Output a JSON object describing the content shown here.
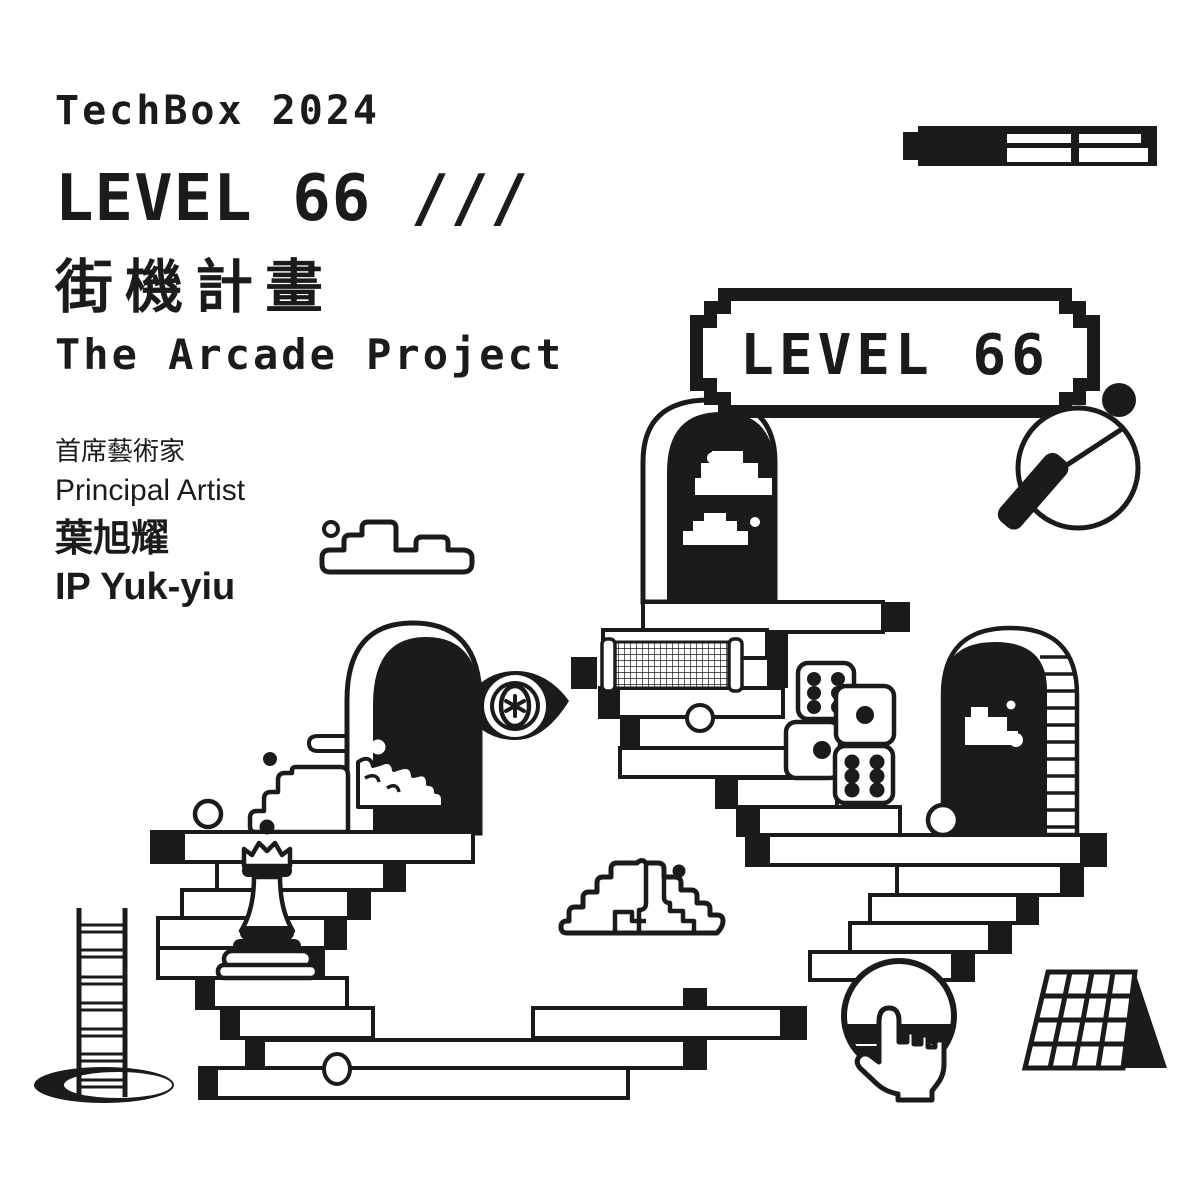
{
  "poster": {
    "event": "TechBox 2024",
    "title_line": "LEVEL 66 ///",
    "title_zh": "街機計畫",
    "subtitle": "The Arcade Project"
  },
  "credits": {
    "role_zh": "首席藝術家",
    "role_en": "Principal Artist",
    "artist_zh": "葉旭耀",
    "artist_en": "IP Yuk-yiu"
  },
  "sign": {
    "label": "LEVEL 66"
  },
  "colors": {
    "ink": "#1b1b1b",
    "paper": "#ffffff"
  },
  "icons": [
    "marker-pen-icon",
    "level-sign",
    "ping-pong-paddle-icon",
    "ping-pong-ball-icon",
    "arch-doorway-center",
    "arch-doorway-left",
    "arch-doorway-right",
    "pixel-cloud-icon",
    "outline-cloud-icon",
    "mountain-cloud-icon",
    "table-tennis-net-icon",
    "dice-icon",
    "eye-icon",
    "chess-queen-icon",
    "staircase-bars",
    "hand-cursor-sphere-icon",
    "grid-panel-icon",
    "ladder-icon",
    "hole-icon"
  ]
}
